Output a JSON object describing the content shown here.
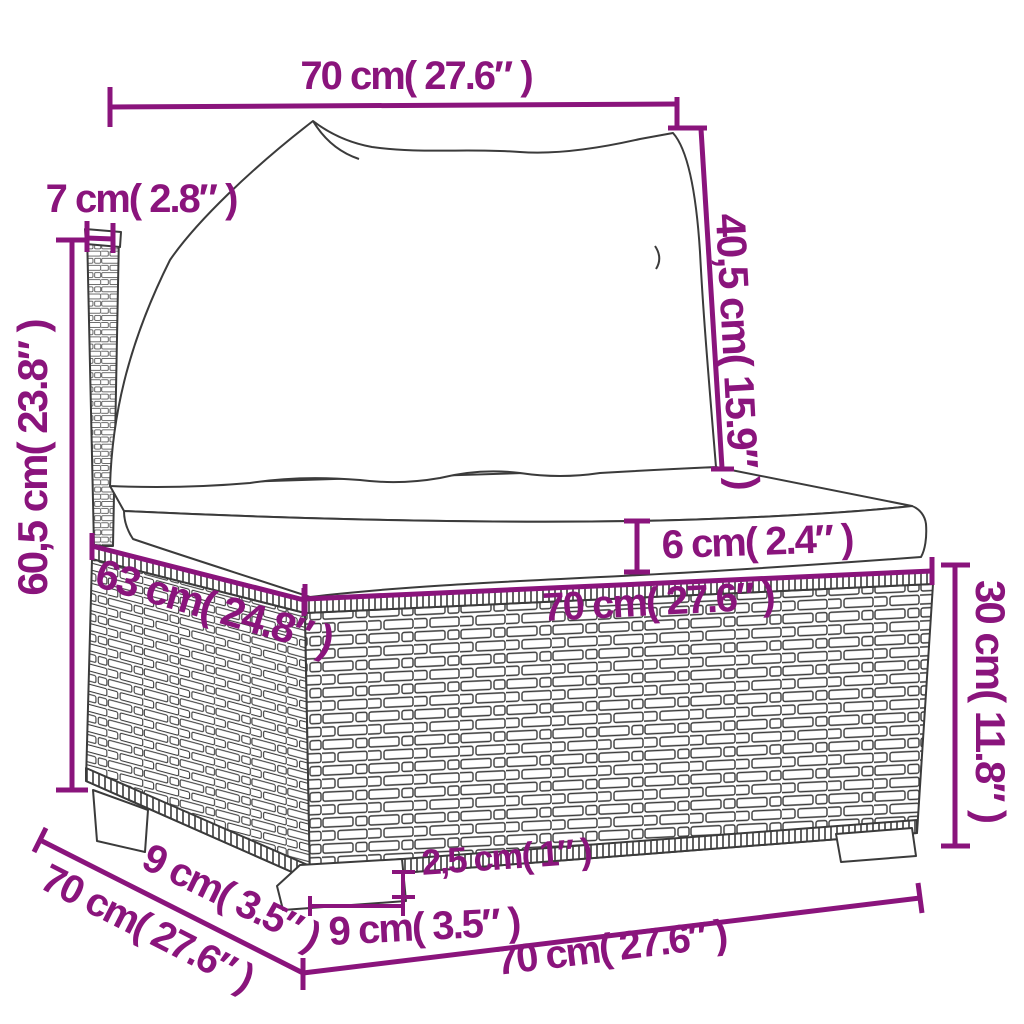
{
  "diagram": {
    "type": "product-dimension-diagram",
    "subject": "poly rattan sofa middle section with cushions",
    "colors": {
      "accent": "#8A147C",
      "line_art": "#3B3B3B",
      "background": "#FFFFFF"
    },
    "dimensions": [
      {
        "id": "back-cushion-width",
        "text": "70 cm( 27.6″ )",
        "cm": "70",
        "inch": "27.6"
      },
      {
        "id": "back-post-width",
        "text": "7 cm( 2.8″ )",
        "cm": "7",
        "inch": "2.8"
      },
      {
        "id": "back-cushion-height",
        "text": "40,5 cm( 15.9″ )",
        "cm": "40,5",
        "inch": "15.9"
      },
      {
        "id": "overall-height",
        "text": "60,5 cm( 23.8″ )",
        "cm": "60,5",
        "inch": "23.8"
      },
      {
        "id": "seat-cushion-thickness",
        "text": "6 cm( 2.4″ )",
        "cm": "6",
        "inch": "2.4"
      },
      {
        "id": "seat-depth",
        "text": "63 cm( 24.8″ )",
        "cm": "63",
        "inch": "24.8"
      },
      {
        "id": "seat-width",
        "text": "70 cm( 27.6″ )",
        "cm": "70",
        "inch": "27.6"
      },
      {
        "id": "base-height",
        "text": "30 cm( 11.8″ )",
        "cm": "30",
        "inch": "11.8"
      },
      {
        "id": "foot-height",
        "text": "2,5 cm( 1″ )",
        "cm": "2,5",
        "inch": "1"
      },
      {
        "id": "foot-width",
        "text": "9 cm( 3.5″ )",
        "cm": "9",
        "inch": "3.5"
      },
      {
        "id": "foot-depth",
        "text": "9 cm( 3.5″ )",
        "cm": "9",
        "inch": "3.5"
      },
      {
        "id": "overall-depth",
        "text": "70 cm( 27.6″ )",
        "cm": "70",
        "inch": "27.6"
      },
      {
        "id": "overall-width",
        "text": "70 cm( 27.6″ )",
        "cm": "70",
        "inch": "27.6"
      }
    ]
  }
}
